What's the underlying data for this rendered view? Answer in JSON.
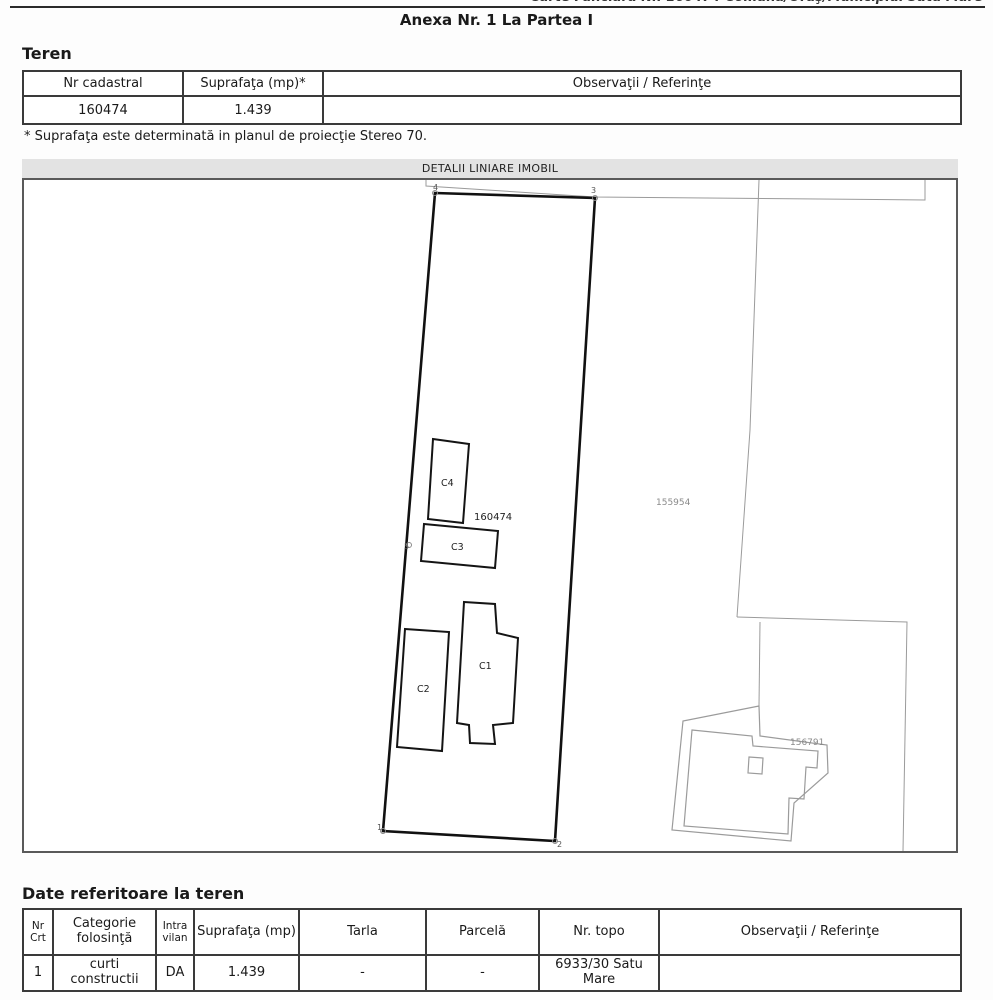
{
  "header": {
    "carte_funciara_line": "Carte Funciară Nr. 160474 Comuna/Oraş/Municipiul Satu Mare",
    "annex_title": "Anexa Nr. 1 La Partea I"
  },
  "teren": {
    "heading": "Teren",
    "table": {
      "headers": [
        "Nr cadastral",
        "Suprafaţa (mp)*",
        "Observaţii / Referinţe"
      ],
      "row": [
        "160474",
        "1.439",
        ""
      ]
    },
    "footnote": "* Suprafaţa este determinată in planul de proiecţie Stereo 70."
  },
  "map": {
    "title": "DETALII LINIARE IMOBIL",
    "labels": {
      "parcel_number": "160474",
      "neighbor_right": "155954",
      "neighbor_bottom_right": "156791",
      "buildings": {
        "c1": "C1",
        "c2": "C2",
        "c3": "C3",
        "c4": "C4"
      },
      "corners": {
        "p1": "1",
        "p2": "2",
        "p3": "3",
        "p4": "4",
        "p5": "5"
      }
    }
  },
  "date_teren": {
    "heading": "Date referitoare la teren",
    "table": {
      "headers": [
        "Nr Crt",
        "Categorie folosinţă",
        "Intra vilan",
        "Suprafaţa (mp)",
        "Tarla",
        "Parcelă",
        "Nr. topo",
        "Observaţii / Referinţe"
      ],
      "row": [
        "1",
        "curti constructii",
        "DA",
        "1.439",
        "-",
        "-",
        "6933/30 Satu Mare",
        ""
      ]
    }
  },
  "colors": {
    "border_dark": "#3a3a3a",
    "map_border": "#5a5a5a",
    "neighbor_gray": "#9b9b9b",
    "band_gray": "#e3e3e3"
  }
}
